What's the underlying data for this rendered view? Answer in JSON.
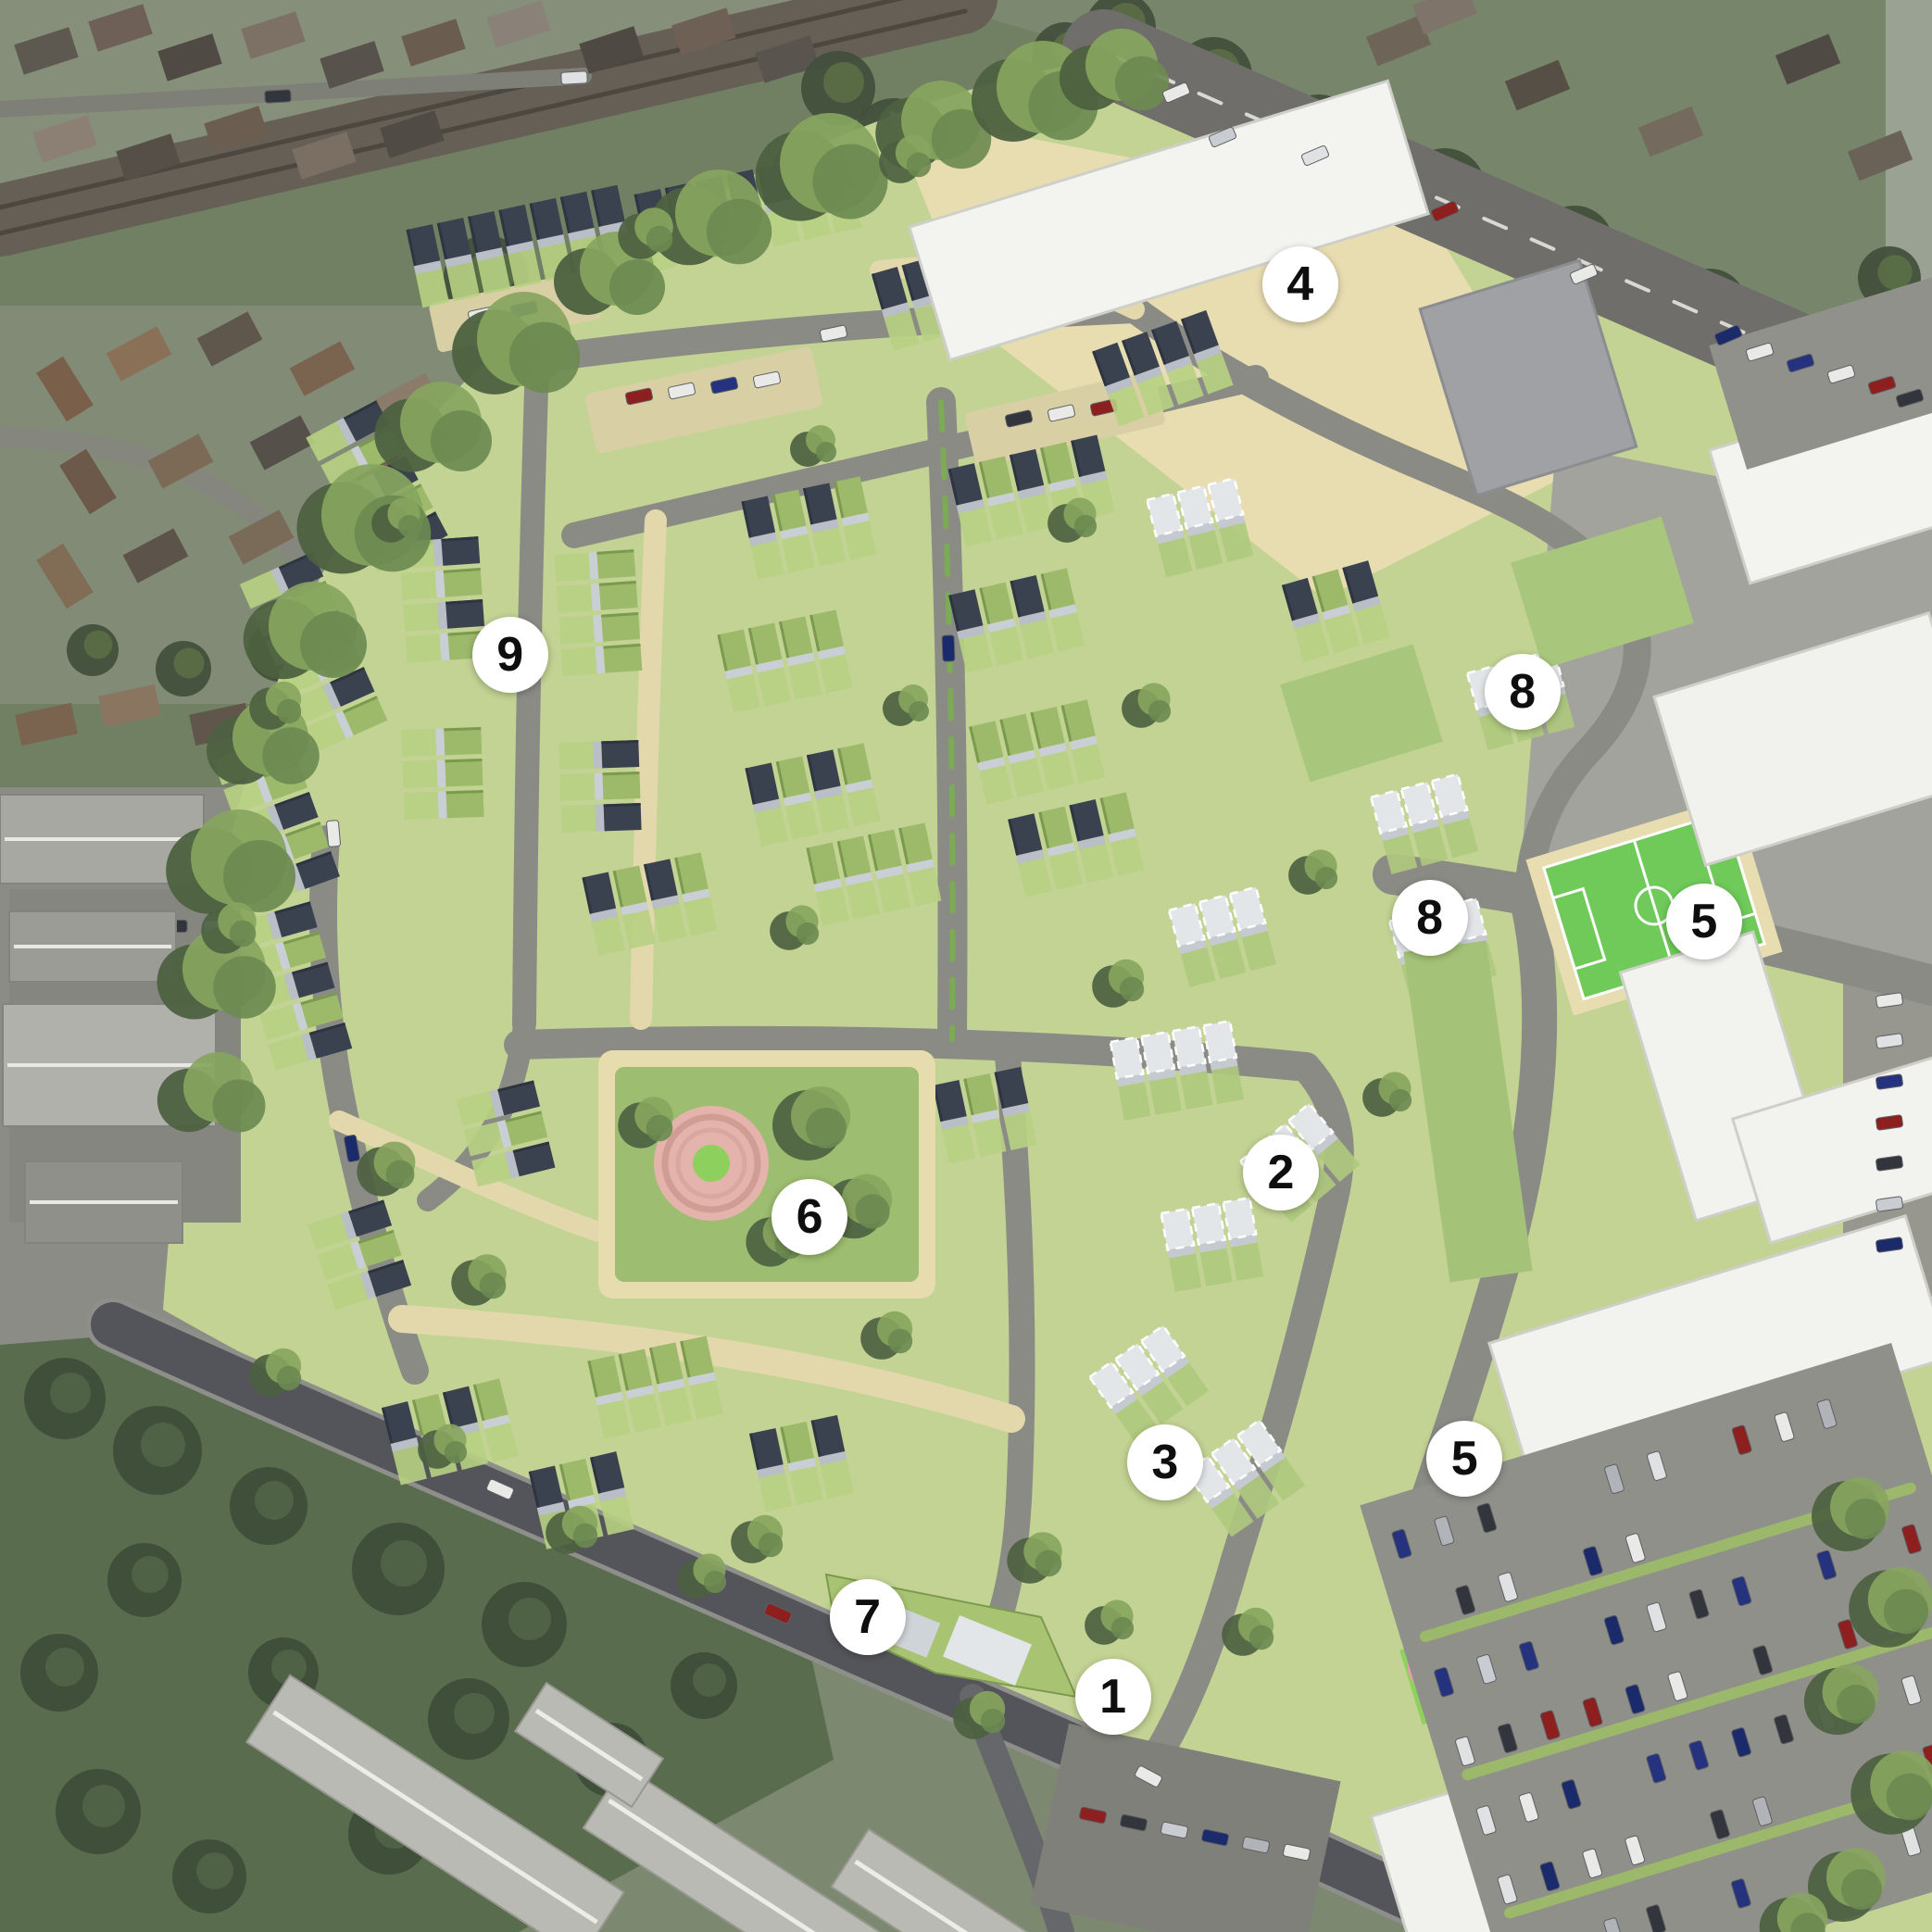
{
  "figure": {
    "type": "aerial-masterplan-visualisation",
    "markers": [
      {
        "label": "4",
        "x_pct": 67.3,
        "y_pct": 14.7
      },
      {
        "label": "9",
        "x_pct": 26.4,
        "y_pct": 33.9
      },
      {
        "label": "8",
        "x_pct": 78.8,
        "y_pct": 35.8
      },
      {
        "label": "8",
        "x_pct": 74.0,
        "y_pct": 47.5
      },
      {
        "label": "5",
        "x_pct": 88.2,
        "y_pct": 47.7
      },
      {
        "label": "2",
        "x_pct": 66.3,
        "y_pct": 60.7
      },
      {
        "label": "6",
        "x_pct": 41.9,
        "y_pct": 63.0
      },
      {
        "label": "3",
        "x_pct": 60.3,
        "y_pct": 75.7
      },
      {
        "label": "5",
        "x_pct": 75.8,
        "y_pct": 75.5
      },
      {
        "label": "7",
        "x_pct": 44.9,
        "y_pct": 83.7
      },
      {
        "label": "1",
        "x_pct": 57.6,
        "y_pct": 87.8
      }
    ],
    "palette": {
      "marker_bg": "#ffffff",
      "marker_text": "#0e0e0e",
      "development_green": "#c3d393",
      "street_grey": "#8b8b86",
      "road_dark": "#54555a",
      "path_beige": "#e3d8ab",
      "pitch_green": "#6fca5a",
      "park_ring_pink": "#e4b3ac",
      "building_white": "#f2f2ef",
      "sedum_roof_green": "#9cba6a",
      "pv_roof_navy": "#3a4250",
      "tree_green": "#6c8a51"
    }
  }
}
